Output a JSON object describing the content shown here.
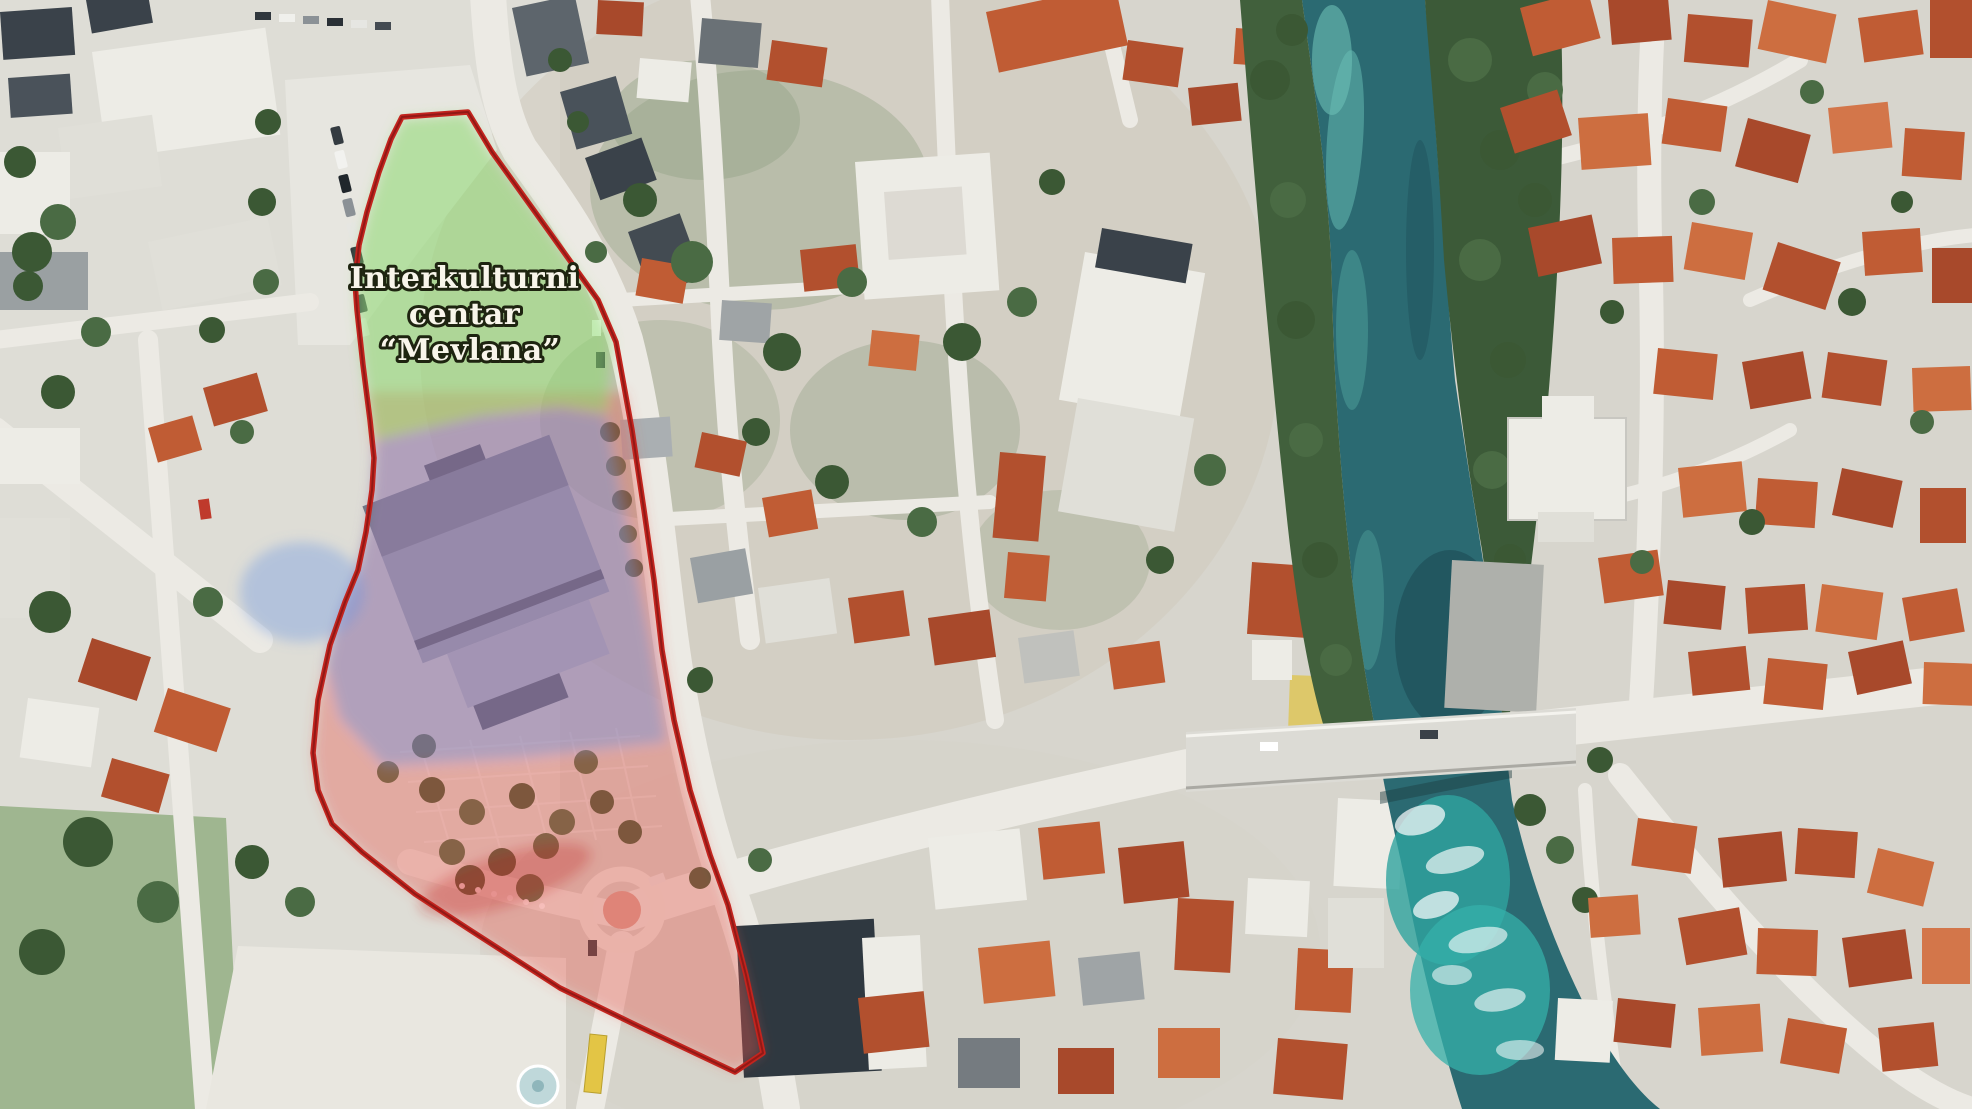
{
  "map": {
    "type": "satellite-annotation",
    "label": {
      "line1": "Interkulturni",
      "line2": "centar",
      "line3": "“Mevlana”"
    },
    "colors": {
      "outline_red": "#c3241e",
      "zone_green": "#8cd86e",
      "zone_blue": "#6e96e1",
      "zone_pink": "#e8554b",
      "river_teal": "#2b6a72",
      "river_rapids": "#35b0aa",
      "bridge_gray": "#dcdbd5"
    }
  }
}
